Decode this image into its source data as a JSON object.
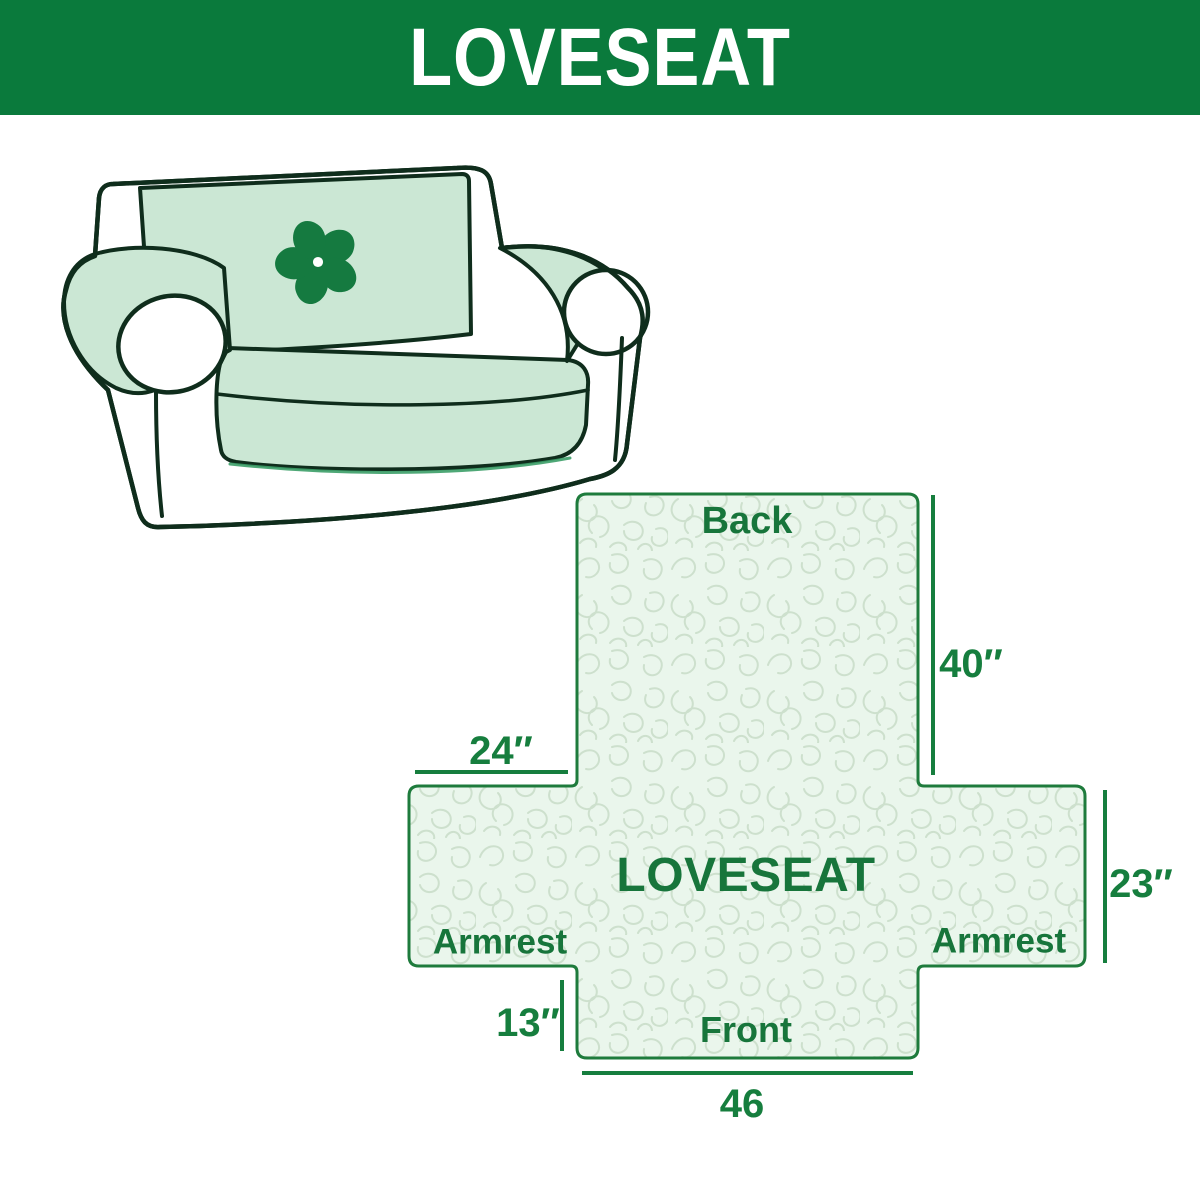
{
  "header": {
    "title": "LOVESEAT",
    "bg_color": "#0a7a3c",
    "text_color": "#ffffff"
  },
  "illustration": {
    "description": "loveseat sofa line drawing with mint slipcover",
    "logo_icon": "pinwheel-icon",
    "cover_color": "#cbe7d4",
    "outline_color": "#0f2d1c",
    "logo_color": "#157a40"
  },
  "diagram": {
    "center_label": "LOVESEAT",
    "back_label": "Back",
    "front_label": "Front",
    "armrest_left_label": "Armrest",
    "armrest_right_label": "Armrest",
    "dim_back_height": "40″",
    "dim_armrest_width": "24″",
    "dim_armrest_height": "23″",
    "dim_front_height": "13″",
    "dim_bottom_width": "46",
    "fill_color": "#eaf6ec",
    "pattern_color": "#cde0cd",
    "border_color": "#1e7b3c",
    "label_color": "#177b3d"
  }
}
